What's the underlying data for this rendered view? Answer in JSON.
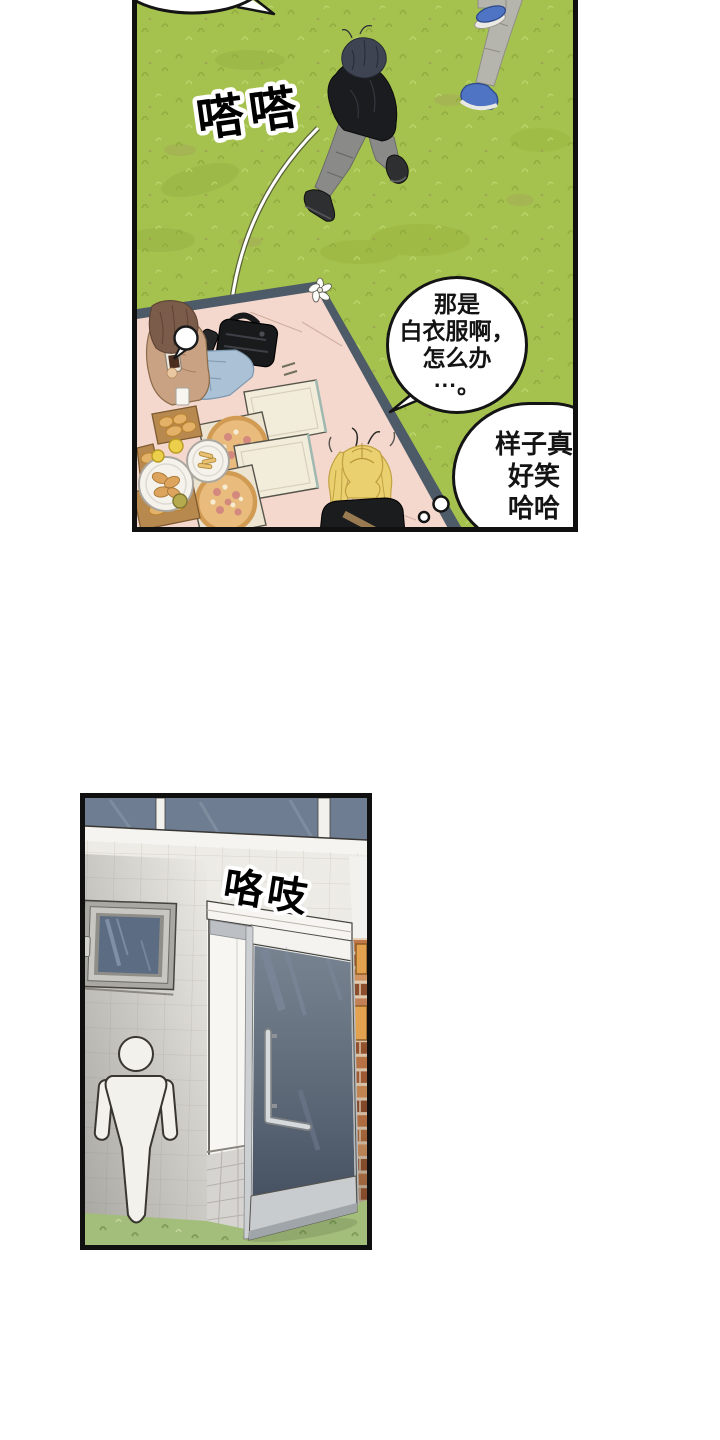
{
  "page": {
    "background": "#ffffff",
    "kind": "webtoon-comic-page"
  },
  "park_panel": {
    "sfx_footsteps": "嗒嗒",
    "speech_bubble": "那是\n白衣服啊，\n怎么办\n···。",
    "thought_bubble": "样子真\n好笑\n哈哈",
    "colors": {
      "grass": "#a5c24f",
      "blanket": "#f5d8cd",
      "blanket_edge": "#4d5a67",
      "outline": "#101010"
    }
  },
  "restroom_panel": {
    "sfx_door_creak": "咯吱",
    "icons": {
      "restroom_sign": "men-pictogram"
    },
    "colors": {
      "tile_wall": "#edebe6",
      "window_glass": "#6e7d92",
      "door_glass": "#5a6878",
      "brick": "#c07848",
      "ground": "#a3bd7a"
    }
  }
}
